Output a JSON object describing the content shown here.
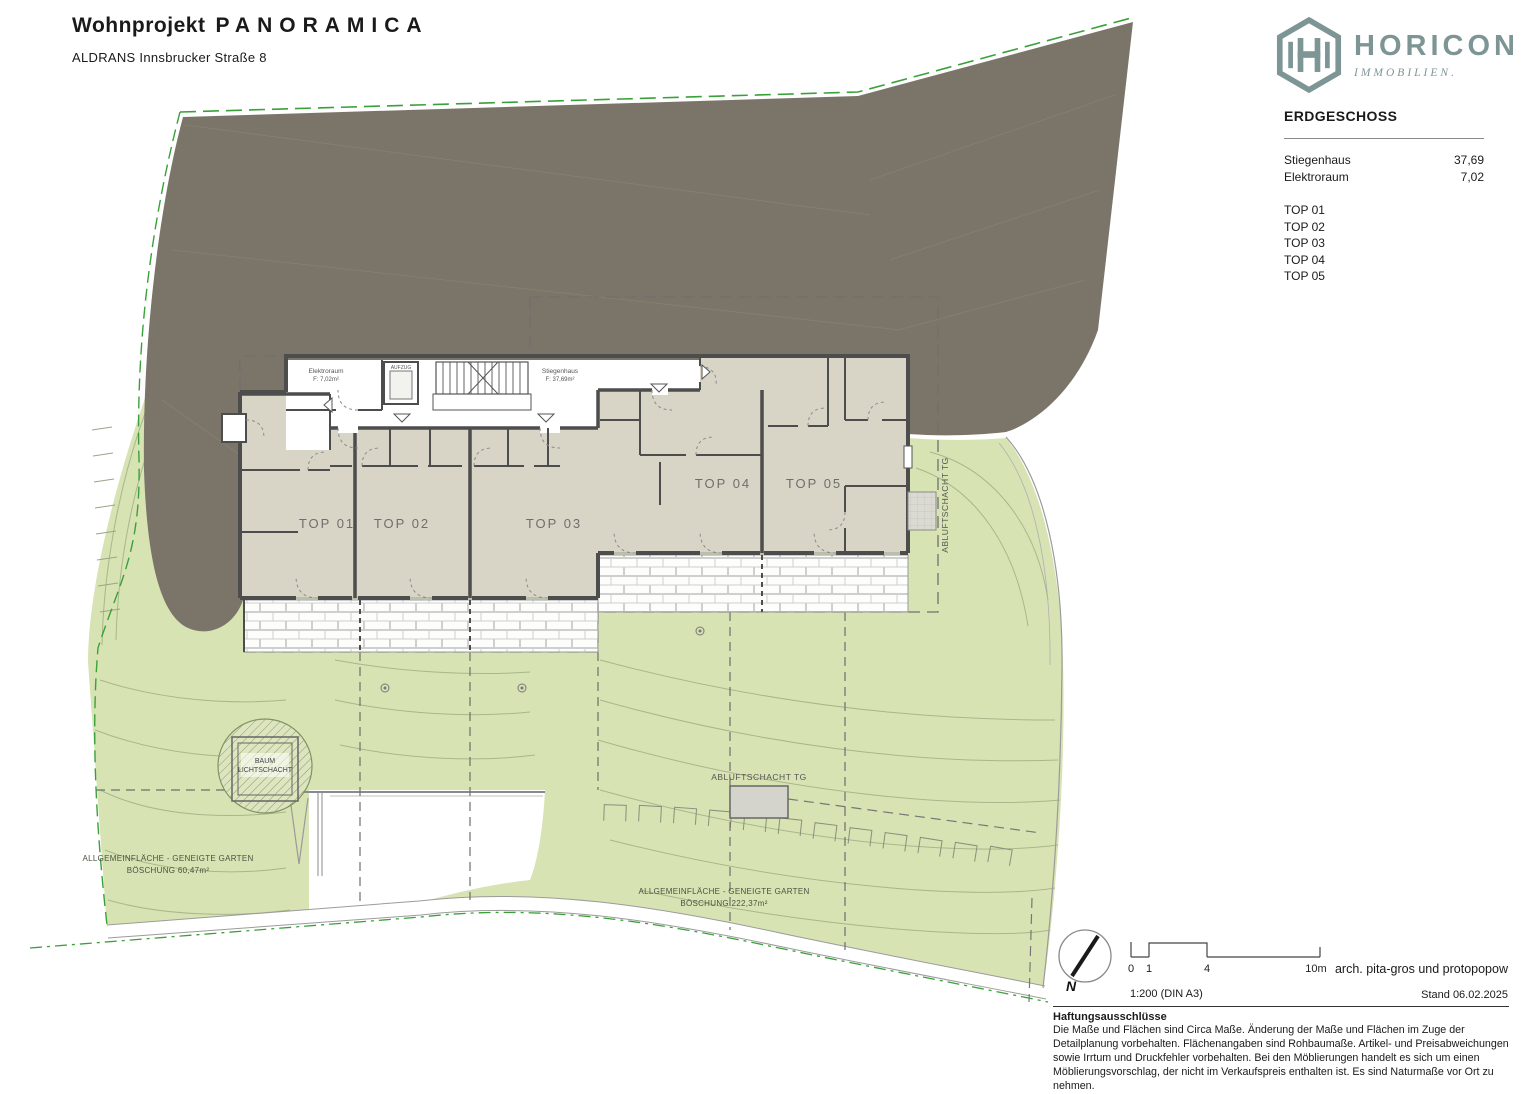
{
  "header": {
    "project_label": "Wohnprojekt",
    "project_name": "PANORAMICA",
    "address": "ALDRANS Innsbrucker Straße 8"
  },
  "logo": {
    "name": "HORICON",
    "tagline": "IMMOBILIEN.",
    "brand_color": "#7E9596"
  },
  "legend": {
    "title": "ERDGESCHOSS",
    "rooms": [
      {
        "label": "Stiegenhaus",
        "value": "37,69"
      },
      {
        "label": "Elektroraum",
        "value": "7,02"
      }
    ],
    "units": [
      "TOP 01",
      "TOP 02",
      "TOP 03",
      "TOP 04",
      "TOP 05"
    ]
  },
  "plan": {
    "rooms": {
      "elektroraum_name": "Elektroraum",
      "elektroraum_area": "F: 7,02m²",
      "stiegenhaus_name": "Stiegenhaus",
      "stiegenhaus_area": "F: 37,69m²",
      "aufzug": "AUFZUG"
    },
    "annotations": {
      "abluft_right": "ABLUFTSCHACHT TG",
      "abluft_bottom": "ABLUFTSCHACHT TG",
      "baum_line1": "BAUM",
      "baum_line2": "LICHTSCHACHT",
      "garden_left_line1": "ALLGEMEINFLÄCHE - GENEIGTE GARTEN",
      "garden_left_line2": "BÖSCHUNG 60,47m²",
      "garden_right_line1": "ALLGEMEINFLÄCHE - GENEIGTE GARTEN",
      "garden_right_line2": "BÖSCHUNG 222,37m²"
    }
  },
  "footer": {
    "north_label": "N",
    "scale_ticks": [
      "0",
      "1",
      "4",
      "10m"
    ],
    "scale_note": "1:200 (DIN A3)",
    "architect": "arch. pita-gros und protopopow",
    "date_note": "Stand 06.02.2025"
  },
  "disclaimer": {
    "title": "Haftungsausschlüsse",
    "body": "Die Maße und Flächen sind Circa Maße. Änderung der Maße und Flächen im Zuge der Detailplanung vorbehalten. Flächenangaben sind Rohbaumaße. Artikel- und Preisabweichungen sowie Irrtum und Druckfehler vorbehalten. Bei den Möblierungen handelt es sich um einen Möblierungsvorschlag, der nicht im Verkaufspreis enthalten ist. Es sind Naturmaße vor Ort zu nehmen."
  }
}
